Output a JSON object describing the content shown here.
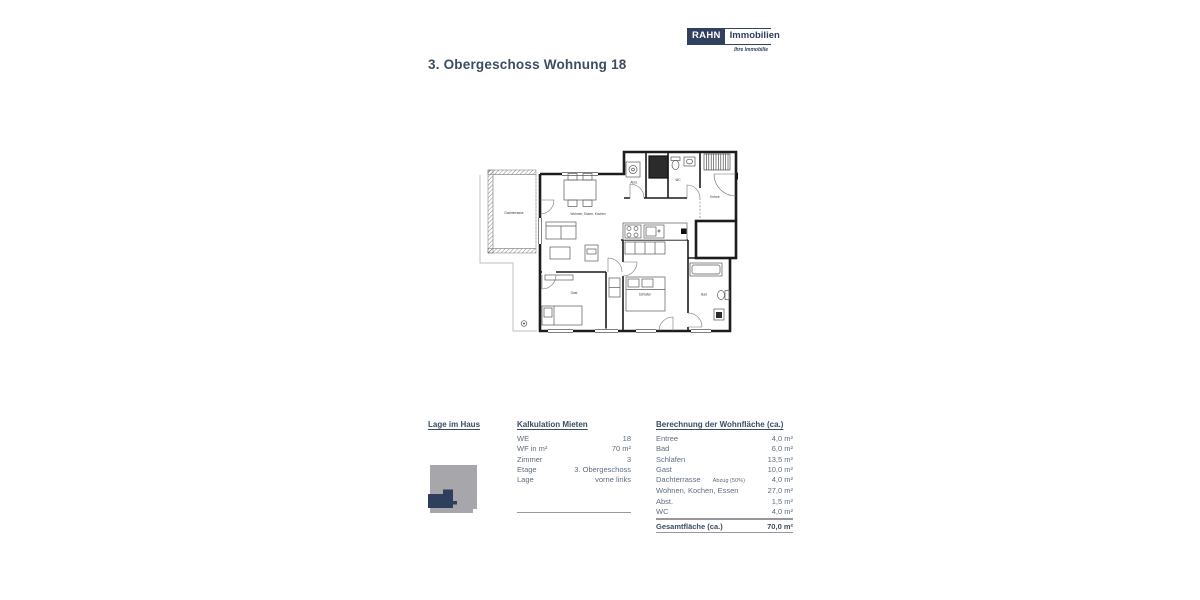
{
  "page": {
    "title": "3. Obergeschoss Wohnung 18"
  },
  "logo": {
    "brand_primary": "RAHN",
    "brand_secondary": "Immobilien",
    "tagline": "Ihre Immobilie"
  },
  "colors": {
    "navy": "#31405f",
    "heading": "#3c4c62",
    "body_text": "#5e6e81",
    "diagram_gray": "#a7a7ab",
    "line_gray": "#97979c"
  },
  "floorplan": {
    "labels": {
      "dachterrasse": "Dachterrasse",
      "wohnen": "Wohnen, Essen, Kochen",
      "abst": "Abst.",
      "wc": "WC",
      "entree": "Entree",
      "gast": "Gast",
      "schlafen": "Schlafen",
      "bad": "Bad"
    }
  },
  "lage_im_haus": {
    "heading": "Lage im Haus"
  },
  "kalkulation": {
    "heading": "Kalkulation Mieten",
    "rows": [
      {
        "label": "WE",
        "value": "18"
      },
      {
        "label": "WF in m²",
        "value": "70 m²"
      },
      {
        "label": "Zimmer",
        "value": "3"
      },
      {
        "label": "Etage",
        "value": "3. Obergeschoss"
      },
      {
        "label": "Lage",
        "value": "vorne links"
      }
    ]
  },
  "berechnung": {
    "heading": "Berechnung der Wohnfläche (ca.)",
    "rows": [
      {
        "label": "Entree",
        "value": "4,0 m²"
      },
      {
        "label": "Bad",
        "value": "6,0 m²"
      },
      {
        "label": "Schlafen",
        "value": "13,5 m²"
      },
      {
        "label": "Gast",
        "value": "10,0 m²"
      },
      {
        "label": "Dachterrasse",
        "note": "Abzug (50%)",
        "value": "4,0 m²"
      },
      {
        "label": "Wohnen, Kochen, Essen",
        "value": "27,0 m²"
      },
      {
        "label": "Abst.",
        "value": "1,5 m²"
      },
      {
        "label": "WC",
        "value": "4,0 m²"
      }
    ],
    "total": {
      "label": "Gesamtfläche (ca.)",
      "value": "70,0 m²"
    }
  }
}
